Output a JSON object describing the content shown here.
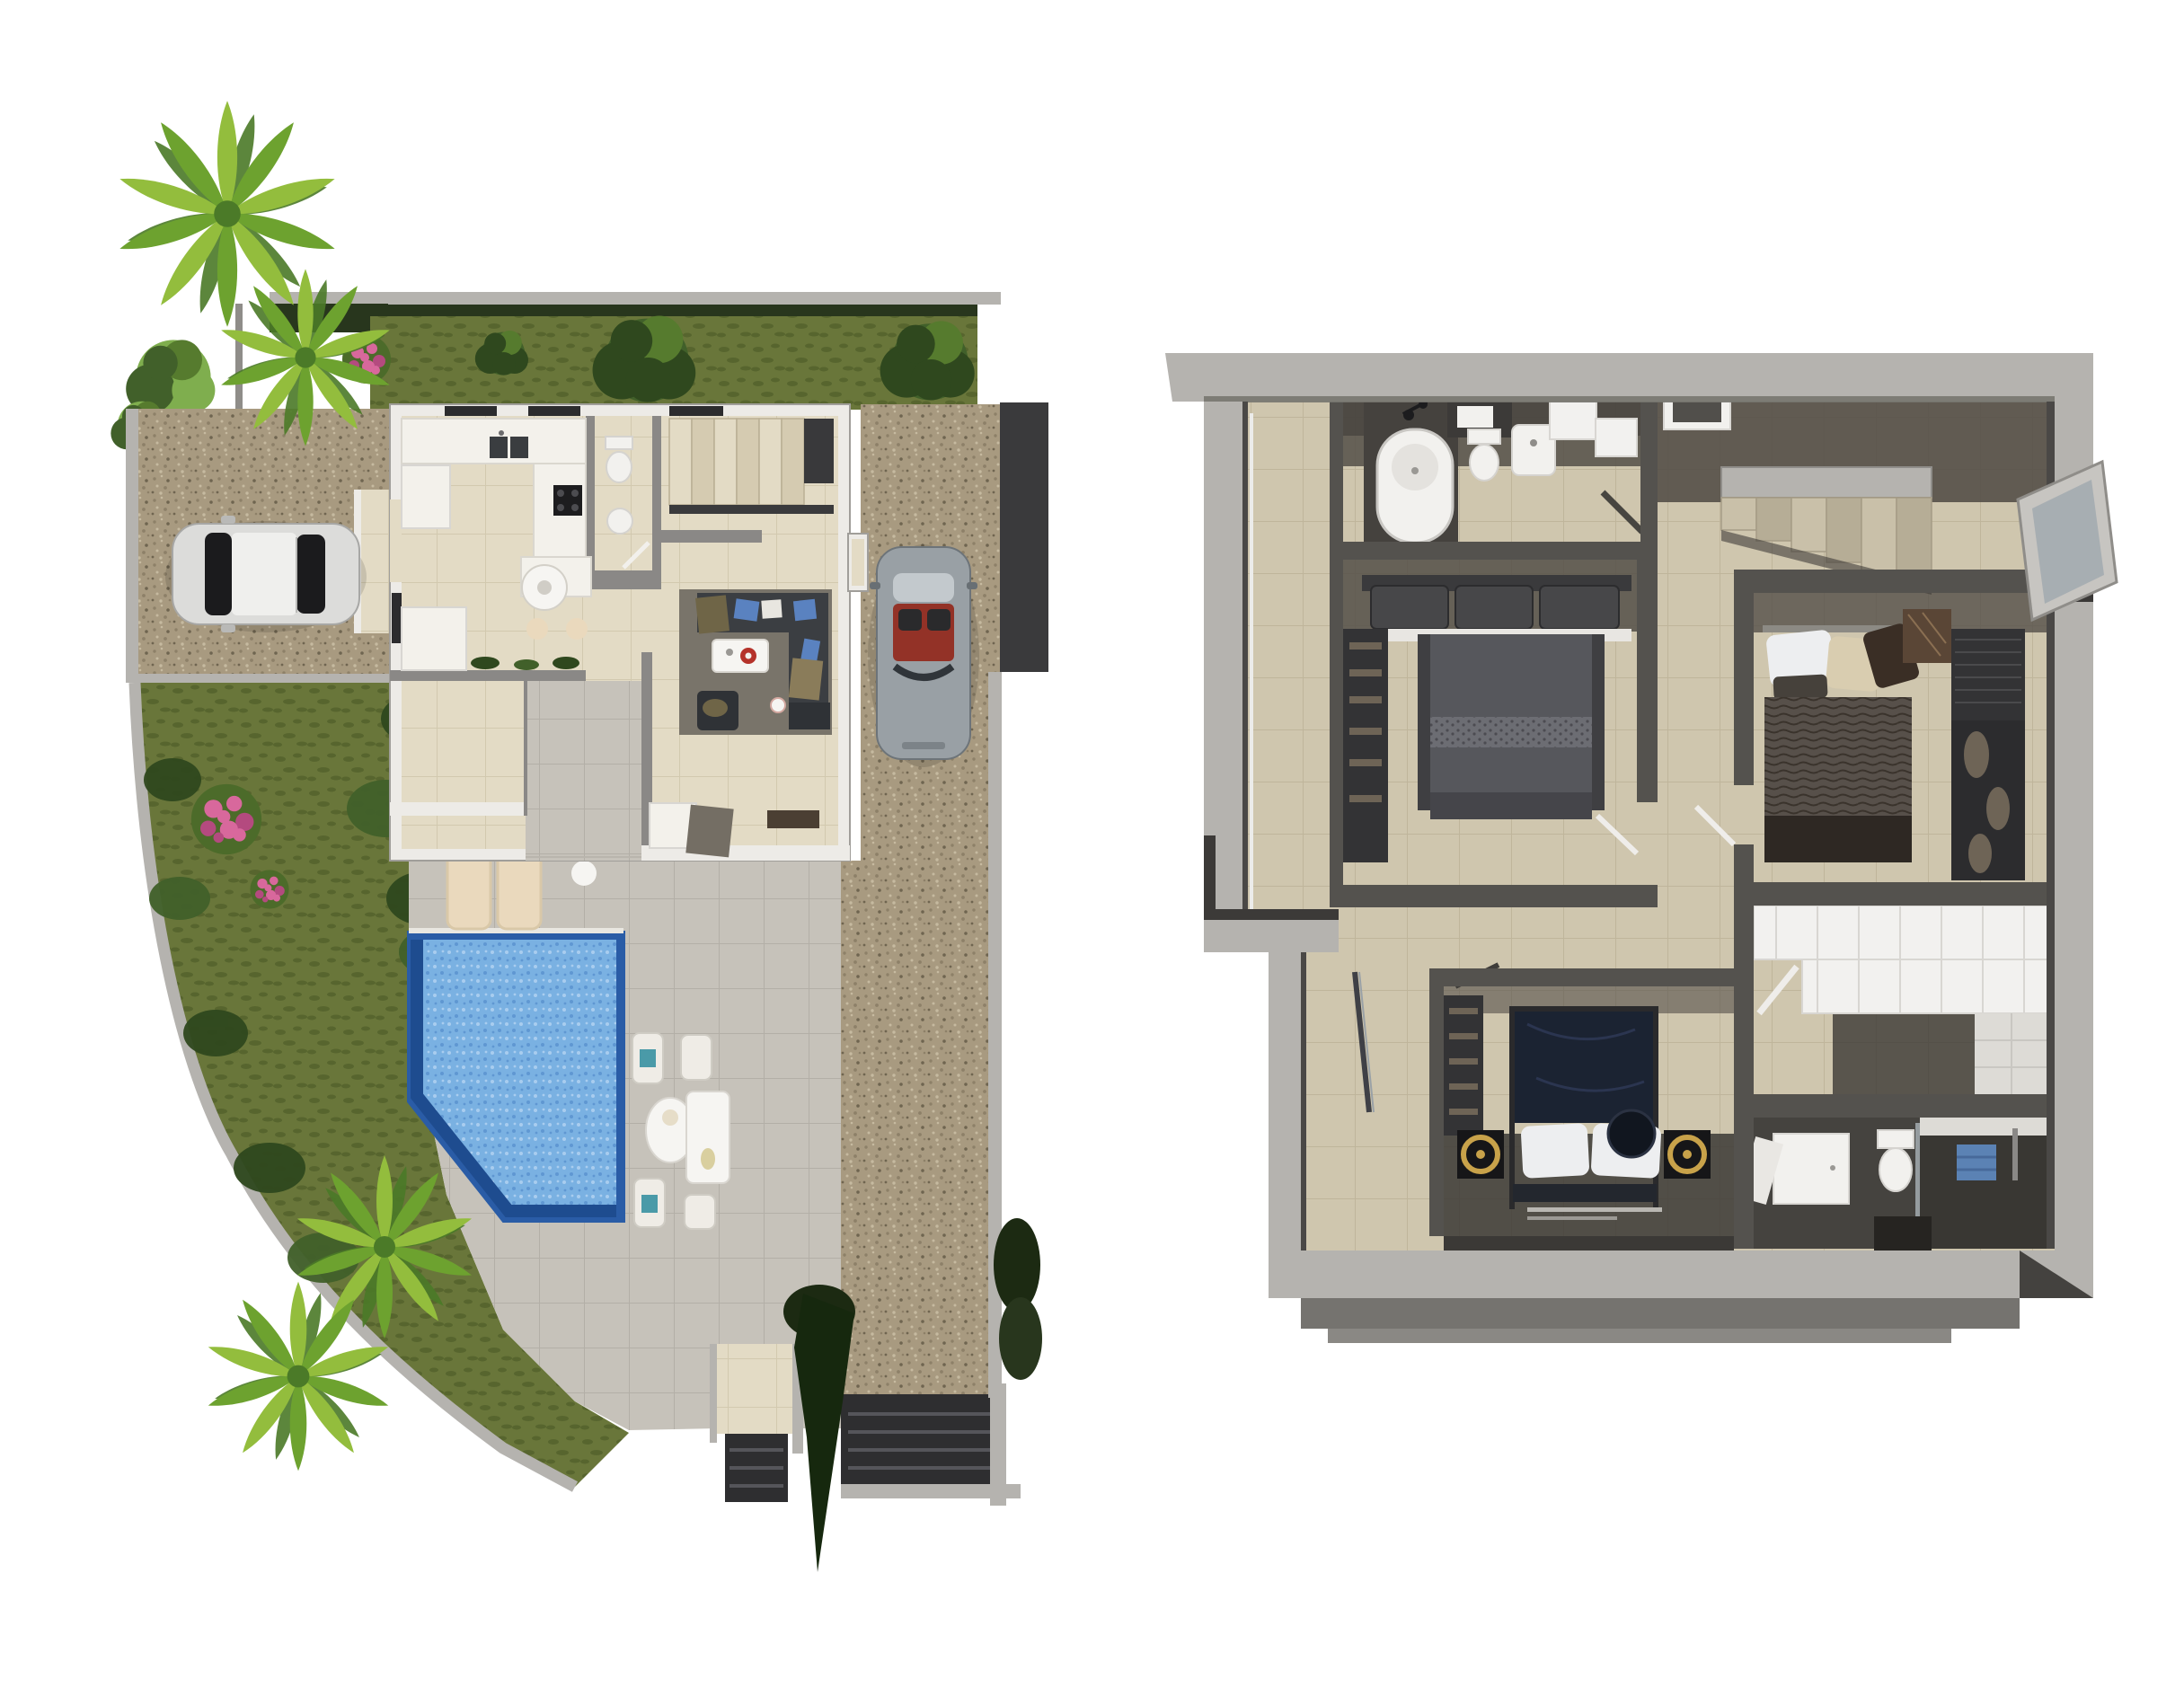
{
  "scene": {
    "type": "architectural-3d-render",
    "panels": [
      {
        "id": "site-plan",
        "label": "villa site plan - ground floor",
        "elements": [
          "palm trees",
          "lawn with trees",
          "hedge garden",
          "pink flower bushes",
          "red flower bushes",
          "gravel driveway",
          "parked white car",
          "parked silver convertible",
          "house ground floor",
          "kitchen",
          "wc",
          "staircase",
          "living room with corner sofa",
          "dining area",
          "inner patio",
          "sun terrace",
          "swimming pool",
          "sun loungers",
          "papasan chair",
          "outdoor dining set",
          "garden walkway",
          "entrance steps",
          "boundary walls",
          "cypress tree"
        ]
      },
      {
        "id": "floor-plan",
        "label": "villa floor plan - upper floor",
        "elements": [
          "side balcony",
          "bathroom with bathtub",
          "toilet",
          "washbasin",
          "bedroom one with double bed",
          "wardrobe",
          "landing with staircase",
          "roof window",
          "open casement window",
          "hallway",
          "bedroom two with double bed",
          "louvered wardrobe",
          "walk-in closet with white cabinets",
          "shower bathroom",
          "blue towel",
          "master bedroom with canopy bed",
          "gold ring side lamps",
          "entrance porch"
        ]
      }
    ]
  },
  "colors": {
    "bg": "#ffffff",
    "grass": "#69763a",
    "grass_dark": "#57652e",
    "tree_dark": "#2f481e",
    "tree_mid": "#41602a",
    "tree_light": "#567b2e",
    "hedge": "#28361d",
    "hedge_dark": "#1c2a12",
    "cypress": "#16280e",
    "palm_light": "#93bd3d",
    "palm_mid": "#6da22f",
    "palm_dark": "#4b7a28",
    "bush_light": "#7fae4e",
    "pink": "#d8689c",
    "pink_dark": "#b44a7f",
    "leaf": "#4c6b2a",
    "red_flower": "#b9393f",
    "red_flower_dark": "#8c2b30",
    "gravel": "#a89a80",
    "gravel_d1": "#8d8068",
    "gravel_d2": "#c6baa0",
    "gravel_d3": "#6f6550",
    "wall_light": "#b5b3af",
    "wall_mid": "#8f8d89",
    "wall_shadow": "#77756f",
    "terrace": "#c6c2ba",
    "terrace_grout": "#b3afa7",
    "walk_dark": "#2e2e30",
    "grille_line": "#55555a",
    "pool": "#7ab1e2",
    "pool_light": "#a9cdef",
    "pool_deep": "#5f97d2",
    "pool_border": "#2a5ca6",
    "pool_edge": "#1e4c8f",
    "coping": "#e9e7e1",
    "house_wall": "#edebe7",
    "house_edge": "#a09e9a",
    "partition": "#8a8886",
    "window_dark": "#2c2c2e",
    "floor_house": "#e3dbc5",
    "floor_grout": "#d2c9af",
    "counter": "#f3f1eb",
    "cooktop": "#1d1d1f",
    "sink_dark": "#3a3d40",
    "rug": "#79746a",
    "sofa": "#3b3e42",
    "sofa_dark": "#2f3236",
    "pillow_blue": "#5a82c0",
    "throw_olive": "#6f6547",
    "white_table": "#f6f5f2",
    "red_accent": "#b5322a",
    "orange_accent": "#d2622a",
    "teal_accent": "#4a9aa8",
    "lounger": "#ead9bd",
    "lounger_edge": "#d9c8a8",
    "car_white": "#dcdcda",
    "car_white_dark": "#b9b9b7",
    "car_glass": "#1b1b1d",
    "car_roof": "#efefed",
    "car_silver": "#99a0a5",
    "car_silver_dark": "#686f74",
    "car_glass_light": "#c3c9cd",
    "car_red": "#933227",
    "plan_floor": "#cfc6ae",
    "plan_grout": "#bfb59b",
    "plan_outer": "#b5b3af",
    "plan_wall": "#54524e",
    "plan_shadow": "#544f48",
    "plan_shadow_deep": "#3b3835",
    "fixture": "#f2f1ee",
    "fixture_shade": "#dddbd6",
    "bed_gray": "#56575c",
    "bed_gray_deep": "#45454a",
    "bed_dots": "#6c6d73",
    "navy": "#1b2332",
    "navy_deep": "#11161f",
    "blanket": "#57504a",
    "blanket_deep": "#2e2823",
    "pillow_white": "#edeef0",
    "pillow_beige": "#d9cdb0",
    "pillow_brown": "#3a2e25",
    "wardrobe": "#333335",
    "wardrobe_slat": "#4a4a4c",
    "clothes": "#6e6456",
    "marble": "#5a4636",
    "marble_vein": "#8a6f52",
    "gold": "#c8a24a",
    "black_table": "#161618",
    "towel": "#5b82b4",
    "cabinet": "#f2f1ef",
    "cabinet_seam": "#d8d6d2",
    "glass_pane": "#a3abb0",
    "porch": "#75736f",
    "porch_light": "#8a8884"
  }
}
